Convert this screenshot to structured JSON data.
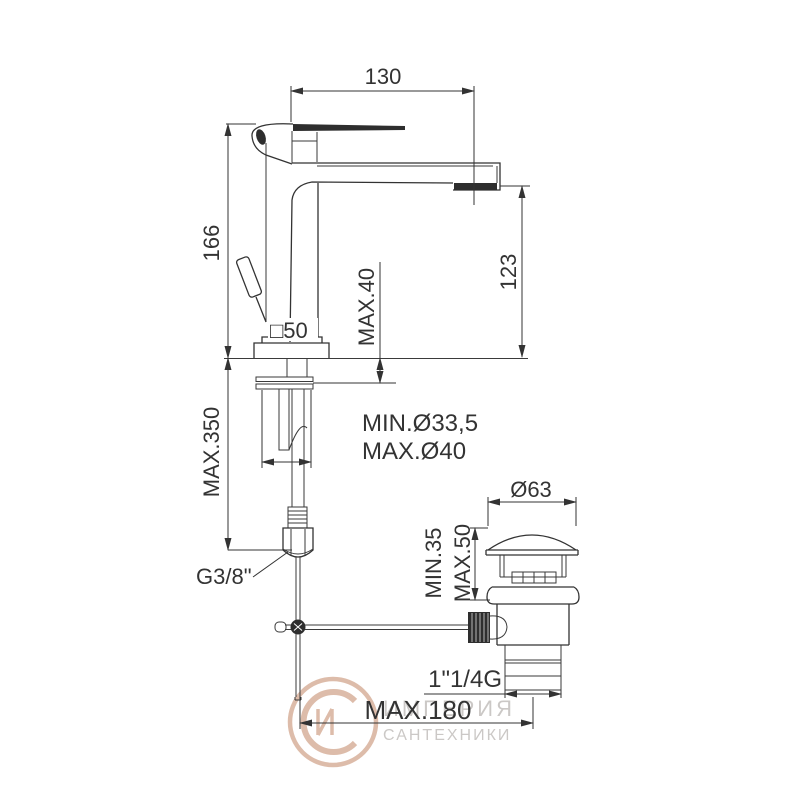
{
  "drawing": {
    "title": "basin-mixer-technical-dimensions",
    "dims": {
      "spout_width": "130",
      "body_height": "166",
      "spout_to_deck": "123",
      "deck_thickness_max": "MAX.40",
      "body_square": "□50",
      "hole_min_diameter": "MIN.Ø33,5",
      "hole_max_diameter": "MAX.Ø40",
      "hose_length_max": "MAX.350",
      "waste_cap_diameter": "Ø63",
      "waste_min_height": "MIN.35",
      "waste_max_height": "MAX.50",
      "supply_thread": "G3/8\"",
      "waste_thread": "1\"1/4G",
      "rod_reach_max": "MAX.180"
    },
    "watermark": {
      "line1": "ИМПЕРИЯ",
      "line2": "САНТЕХНИКИ"
    },
    "colors": {
      "line": "#333333",
      "label": "#333333",
      "watermark_text": "#c9c6c3",
      "watermark_logo": "#dcb9a6",
      "background": "#ffffff"
    }
  }
}
